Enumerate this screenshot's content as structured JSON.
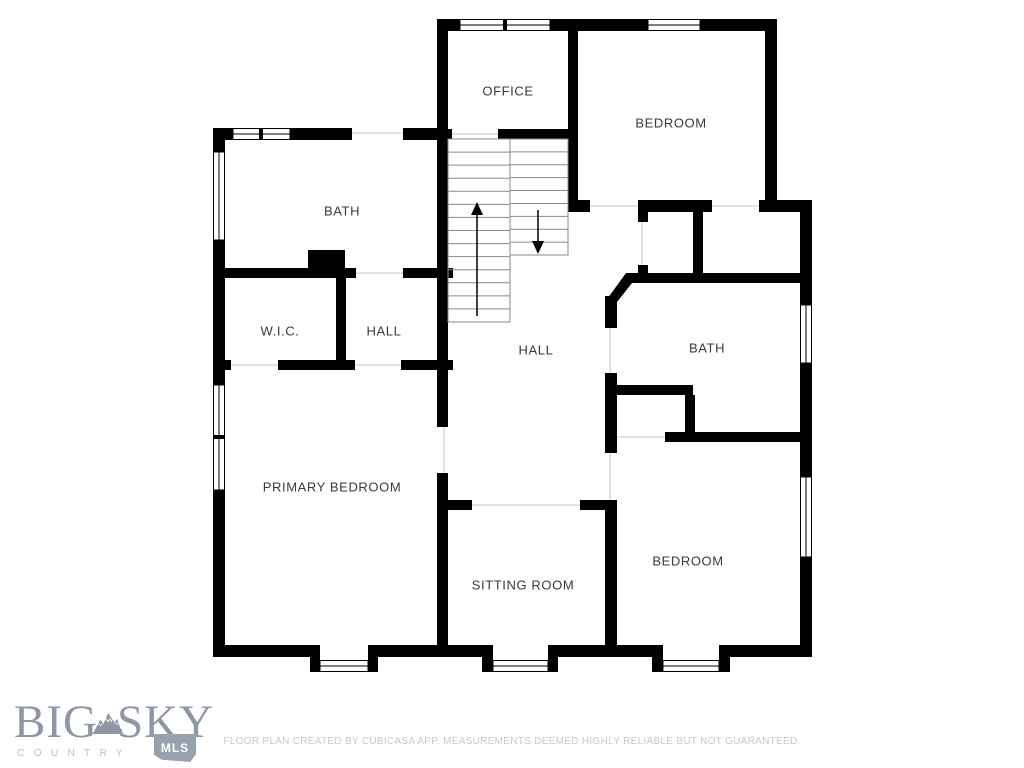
{
  "rooms": [
    {
      "id": "office",
      "label": "OFFICE"
    },
    {
      "id": "bedroom-top",
      "label": "BEDROOM"
    },
    {
      "id": "bath-upper-left",
      "label": "BATH"
    },
    {
      "id": "wic",
      "label": "W.I.C."
    },
    {
      "id": "hall-small",
      "label": "HALL"
    },
    {
      "id": "hall-main",
      "label": "HALL"
    },
    {
      "id": "bath-right",
      "label": "BATH"
    },
    {
      "id": "primary-bedroom",
      "label": "PRIMARY BEDROOM"
    },
    {
      "id": "sitting-room",
      "label": "SITTING ROOM"
    },
    {
      "id": "bedroom-bottom",
      "label": "BEDROOM"
    }
  ],
  "stairs": {
    "up_flight_treads": 14,
    "down_flight_treads": 9
  },
  "logo": {
    "word1": "BIG",
    "word2": "SKY",
    "subtitle": "COUNTRY",
    "badge": "MLS"
  },
  "footer": {
    "disclaimer": "FLOOR PLAN CREATED BY CUBICASA APP. MEASUREMENTS DEEMED HIGHLY RELIABLE BUT NOT GUARANTEED."
  },
  "colors": {
    "wall": "#000000",
    "label": "#3a3a3a",
    "logo": "#8f97a6",
    "logo_sub": "#bdc1cb",
    "badge": "#99a1af",
    "footer_text": "#c9c9c9"
  }
}
